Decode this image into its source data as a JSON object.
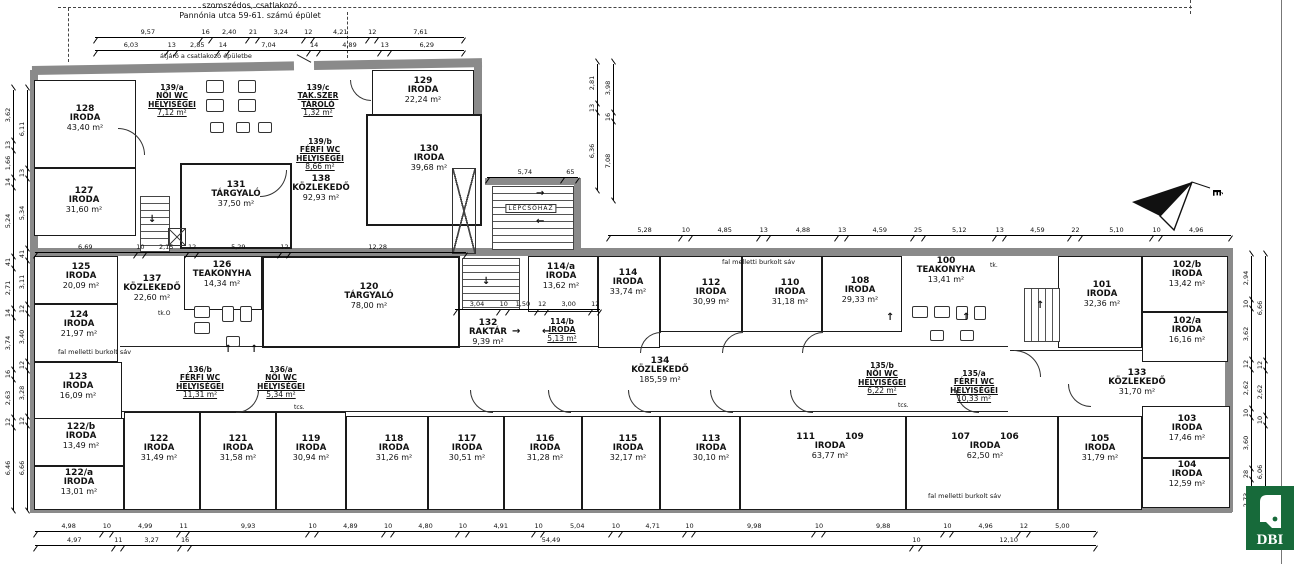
{
  "site": {
    "neighbor_line1": "szomszédos, csatlakozó",
    "neighbor_line2": "Pannónia utca 59-61. számú épület",
    "passage_note": "átjáró a csatlakozó épületbe",
    "wall_strip_note": "fal melletti burkolt sáv",
    "stairwell_label": "LÉPCSŐHÁZ",
    "north_letter": "É"
  },
  "logo": {
    "text": "DBI",
    "green": "#176a3a"
  },
  "annotations": {
    "tk_o": "tk.O",
    "tcs": "tcs.",
    "tk": "tk."
  },
  "rooms": [
    {
      "id": "128",
      "number": "128",
      "type": "IRODA",
      "area": "43,40 m²"
    },
    {
      "id": "127",
      "number": "127",
      "type": "IRODA",
      "area": "31,60 m²"
    },
    {
      "id": "139a",
      "number": "139/a",
      "type": "NŐI WC HELYISÉGEI",
      "area": "7,12 m²"
    },
    {
      "id": "139c",
      "number": "139/c",
      "type": "TAK.SZER TÁROLÓ",
      "area": "1,32 m²"
    },
    {
      "id": "139b",
      "number": "139/b",
      "type": "FÉRFI WC HELYISÉGEI",
      "area": "8,66 m²"
    },
    {
      "id": "138",
      "number": "138",
      "type": "KÖZLEKEDŐ",
      "area": "92,93 m²"
    },
    {
      "id": "131",
      "number": "131",
      "type": "TÁRGYALÓ",
      "area": "37,50 m²"
    },
    {
      "id": "129",
      "number": "129",
      "type": "IRODA",
      "area": "22,24 m²"
    },
    {
      "id": "130",
      "number": "130",
      "type": "IRODA",
      "area": "39,68 m²"
    },
    {
      "id": "125",
      "number": "125",
      "type": "IRODA",
      "area": "20,09 m²"
    },
    {
      "id": "124",
      "number": "124",
      "type": "IRODA",
      "area": "21,97 m²"
    },
    {
      "id": "123",
      "number": "123",
      "type": "IRODA",
      "area": "16,09 m²"
    },
    {
      "id": "137",
      "number": "137",
      "type": "KÖZLEKEDŐ",
      "area": "22,60 m²"
    },
    {
      "id": "126",
      "number": "126",
      "type": "TEAKONYHA",
      "area": "14,34 m²"
    },
    {
      "id": "120",
      "number": "120",
      "type": "TÁRGYALÓ",
      "area": "78,00 m²"
    },
    {
      "id": "132",
      "number": "132",
      "type": "RAKTÁR",
      "area": "9,39 m²"
    },
    {
      "id": "136b",
      "number": "136/b",
      "type": "FÉRFI WC HELYISÉGEI",
      "area": "11,31 m²"
    },
    {
      "id": "136a",
      "number": "136/a",
      "type": "NŐI WC HELYISÉGEI",
      "area": "5,34 m²"
    },
    {
      "id": "114a",
      "number": "114/a",
      "type": "IRODA",
      "area": "13,62 m²"
    },
    {
      "id": "114",
      "number": "114",
      "type": "IRODA",
      "area": "33,74 m²"
    },
    {
      "id": "114b",
      "number": "114/b",
      "type": "IRODA",
      "area": "5,13 m²"
    },
    {
      "id": "112",
      "number": "112",
      "type": "IRODA",
      "area": "30,99 m²"
    },
    {
      "id": "110",
      "number": "110",
      "type": "IRODA",
      "area": "31,18 m²"
    },
    {
      "id": "108",
      "number": "108",
      "type": "IRODA",
      "area": "29,33 m²"
    },
    {
      "id": "100",
      "number": "100",
      "type": "TEAKONYHA",
      "area": "13,41 m²"
    },
    {
      "id": "135b",
      "number": "135/b",
      "type": "NŐI WC HELYISÉGEI",
      "area": "6,22 m²"
    },
    {
      "id": "135a",
      "number": "135/a",
      "type": "FÉRFI WC HELYISÉGEI",
      "area": "10,33 m²"
    },
    {
      "id": "134",
      "number": "134",
      "type": "KÖZLEKEDŐ",
      "area": "185,59 m²"
    },
    {
      "id": "133",
      "number": "133",
      "type": "KÖZLEKEDŐ",
      "area": "31,70 m²"
    },
    {
      "id": "101",
      "number": "101",
      "type": "IRODA",
      "area": "32,36 m²"
    },
    {
      "id": "102b",
      "number": "102/b",
      "type": "IRODA",
      "area": "13,42 m²"
    },
    {
      "id": "102a",
      "number": "102/a",
      "type": "IRODA",
      "area": "16,16 m²"
    },
    {
      "id": "122b",
      "number": "122/b",
      "type": "IRODA",
      "area": "13,49 m²"
    },
    {
      "id": "122a",
      "number": "122/a",
      "type": "IRODA",
      "area": "13,01 m²"
    },
    {
      "id": "122",
      "number": "122",
      "type": "IRODA",
      "area": "31,49 m²"
    },
    {
      "id": "121",
      "number": "121",
      "type": "IRODA",
      "area": "31,58 m²"
    },
    {
      "id": "119",
      "number": "119",
      "type": "IRODA",
      "area": "30,94 m²"
    },
    {
      "id": "118",
      "number": "118",
      "type": "IRODA",
      "area": "31,26 m²"
    },
    {
      "id": "117",
      "number": "117",
      "type": "IRODA",
      "area": "30,51 m²"
    },
    {
      "id": "116",
      "number": "116",
      "type": "IRODA",
      "area": "31,28 m²"
    },
    {
      "id": "115",
      "number": "115",
      "type": "IRODA",
      "area": "32,17 m²"
    },
    {
      "id": "113",
      "number": "113",
      "type": "IRODA",
      "area": "30,10 m²"
    },
    {
      "id": "111_109",
      "number": "111",
      "number2": "109",
      "type": "IRODA",
      "area": "63,77 m²"
    },
    {
      "id": "107_106",
      "number": "107",
      "number2": "106",
      "type": "IRODA",
      "area": "62,50 m²"
    },
    {
      "id": "105",
      "number": "105",
      "type": "IRODA",
      "area": "31,79 m²"
    },
    {
      "id": "103",
      "number": "103",
      "type": "IRODA",
      "area": "17,46 m²"
    },
    {
      "id": "104",
      "number": "104",
      "type": "IRODA",
      "area": "12,59 m²"
    }
  ],
  "dimensions": {
    "top1": [
      "9,57",
      "16",
      "2,40",
      "21",
      "3,24",
      "12",
      "4,21",
      "12",
      "7,61"
    ],
    "top2": [
      "6,03",
      "13",
      "2,85",
      "14",
      "7,04",
      "14",
      "4,89",
      "13",
      "6,29"
    ],
    "wing": [
      "6,69",
      "10",
      "2,15",
      "12",
      "5,29",
      "12",
      "12,28"
    ],
    "mid": [
      "5,28",
      "10",
      "4,85",
      "13",
      "4,88",
      "13",
      "4,59",
      "25",
      "5,12",
      "13",
      "4,59",
      "22",
      "5,10",
      "10",
      "4,96"
    ],
    "bottom1": [
      "4,98",
      "10",
      "4,99",
      "11",
      "9,93",
      "10",
      "4,89",
      "10",
      "4,80",
      "10",
      "4,91",
      "10",
      "5,04",
      "10",
      "4,71",
      "10",
      "9,98",
      "10",
      "9,88",
      "10",
      "4,96",
      "12",
      "5,00"
    ],
    "bottom2": [
      "4,97",
      "11",
      "3,27",
      "16",
      "54,49",
      "10",
      "12,10"
    ],
    "left_outer": [
      "3,62",
      "13",
      "1,66",
      "14",
      "5,24",
      "41",
      "2,71",
      "14",
      "3,74",
      "16",
      "2,63",
      "12",
      "6,46"
    ],
    "left_inner": [
      "6,11",
      "13",
      "5,34",
      "41",
      "3,11",
      "12",
      "3,40",
      "12",
      "3,28",
      "12",
      "6,66"
    ],
    "right_outer": [
      "2,94",
      "10",
      "3,62",
      "12",
      "2,62",
      "10",
      "3,60",
      "28",
      "2,73"
    ],
    "right_inner": [
      "6,66",
      "12",
      "2,62",
      "10",
      "6,06"
    ],
    "stair_h": [
      "5,74",
      "65"
    ],
    "stair_v1": [
      "2,81",
      "13",
      "6,36"
    ],
    "stair_v2": [
      "3,98",
      "16",
      "7,08"
    ],
    "raktar": [
      "3,04",
      "10",
      "1,50",
      "12",
      "3,00",
      "12"
    ]
  }
}
